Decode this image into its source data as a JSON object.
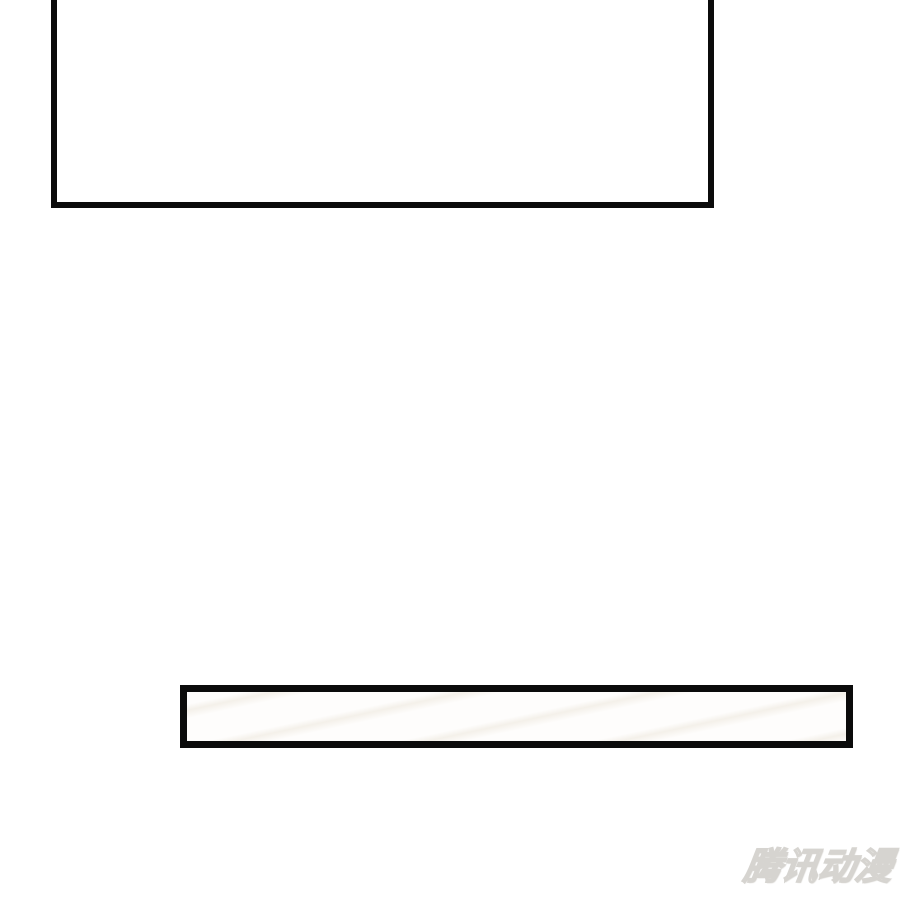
{
  "watermark": {
    "text": "腾讯动漫"
  },
  "colors": {
    "page_background": "#ffffff",
    "panel_border": "#0b0b0b",
    "panel_fill": "#ffffff",
    "strip_streak": "#ece6db",
    "watermark_outline": "#d6d4d0",
    "watermark_fill": "#f2f1ee"
  }
}
